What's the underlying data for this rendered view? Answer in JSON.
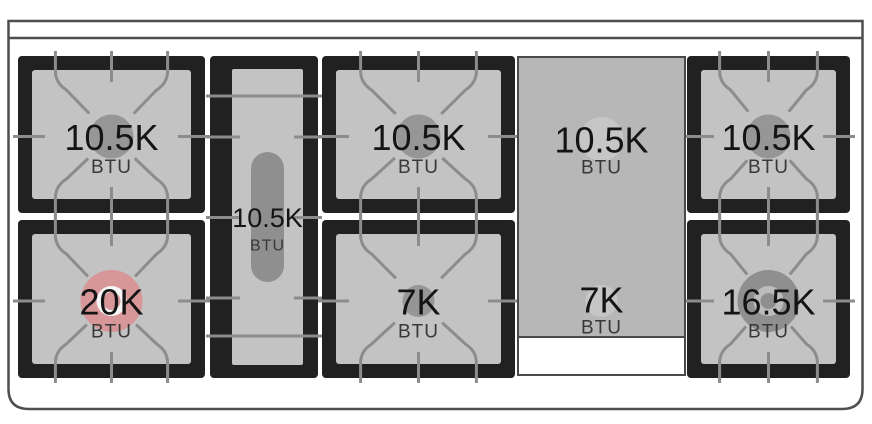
{
  "diagram": {
    "name": "range-cooktop-burner-layout",
    "burners": {
      "back_left": {
        "value": "10.5K",
        "unit": "BTU"
      },
      "front_left": {
        "value": "20K",
        "unit": "BTU",
        "highlighted": true
      },
      "center_oval": {
        "value": "10.5K",
        "unit": "BTU"
      },
      "back_center": {
        "value": "10.5K",
        "unit": "BTU"
      },
      "front_center": {
        "value": "7K",
        "unit": "BTU"
      },
      "griddle_back": {
        "value": "10.5K",
        "unit": "BTU"
      },
      "griddle_front": {
        "value": "7K",
        "unit": "BTU"
      },
      "back_right": {
        "value": "10.5K",
        "unit": "BTU"
      },
      "front_right": {
        "value": "16.5K",
        "unit": "BTU"
      }
    },
    "colors": {
      "frame_black": "#212121",
      "surface_gray": "#c3c3c3",
      "grate_line": "#8c8c8c",
      "burner_gray": "#969696",
      "oval_burner": "#8f8f8f",
      "griddle_gray": "#b7b7b7",
      "griddle_circle": "#c6c6c6",
      "highlight_pink": "#d79697",
      "ring_white": "#f5f5f5",
      "ring_gray": "#bcbcbc",
      "ring_dark": "#8f8f8f",
      "outline_gray": "#4f4f4f"
    }
  }
}
